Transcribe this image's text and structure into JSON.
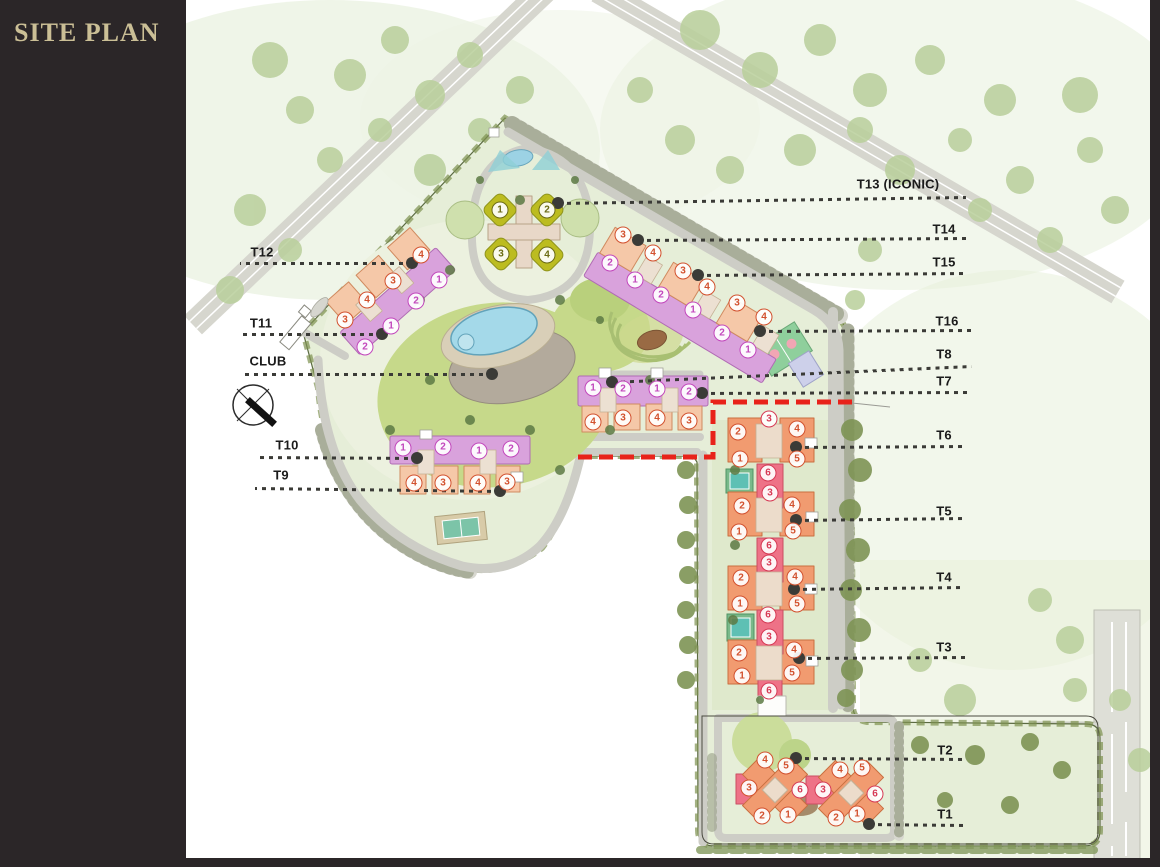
{
  "title": "SITE PLAN",
  "colors": {
    "sidebar_bg": "#2B2628",
    "title_gold": "#CBBF96",
    "label_ink": "#1B1B1B",
    "leader": "#3B3B37",
    "red_boundary": "#E8221A",
    "purple_building": "#D9A2DC",
    "salmon_building": "#F5C8A8",
    "olive_building": "#BCBC20",
    "orange_building": "#F19B70",
    "pink_building": "#EE7287",
    "marker_m": "#C247BC",
    "marker_o": "#D2512E",
    "marker_r": "#D63A55",
    "marker_y": "#6B6B14"
  },
  "callouts": [
    {
      "id": "T13",
      "label": "T13 (ICONIC)",
      "lx": 898,
      "ly": 184,
      "x1": 558,
      "y1": 203,
      "x2": 966,
      "y2": 197
    },
    {
      "id": "T14",
      "label": "T14",
      "lx": 944,
      "ly": 229,
      "x1": 638,
      "y1": 240,
      "x2": 966,
      "y2": 238
    },
    {
      "id": "T15",
      "label": "T15",
      "lx": 944,
      "ly": 262,
      "x1": 698,
      "y1": 275,
      "x2": 966,
      "y2": 273
    },
    {
      "id": "T16",
      "label": "T16",
      "lx": 947,
      "ly": 321,
      "x1": 760,
      "y1": 331,
      "x2": 972,
      "y2": 330
    },
    {
      "id": "T8",
      "label": "T8",
      "lx": 944,
      "ly": 354,
      "x1": 612,
      "y1": 382,
      "x2": 972,
      "y2": 366
    },
    {
      "id": "T7",
      "label": "T7",
      "lx": 944,
      "ly": 381,
      "x1": 702,
      "y1": 393,
      "x2": 972,
      "y2": 392
    },
    {
      "id": "T6",
      "label": "T6",
      "lx": 944,
      "ly": 435,
      "x1": 796,
      "y1": 447,
      "x2": 965,
      "y2": 446
    },
    {
      "id": "T5",
      "label": "T5",
      "lx": 944,
      "ly": 511,
      "x1": 796,
      "y1": 520,
      "x2": 965,
      "y2": 518
    },
    {
      "id": "T4",
      "label": "T4",
      "lx": 944,
      "ly": 577,
      "x1": 794,
      "y1": 589,
      "x2": 965,
      "y2": 587
    },
    {
      "id": "T3",
      "label": "T3",
      "lx": 944,
      "ly": 647,
      "x1": 799,
      "y1": 658,
      "x2": 965,
      "y2": 657
    },
    {
      "id": "T2",
      "label": "T2",
      "lx": 945,
      "ly": 750,
      "x1": 796,
      "y1": 758,
      "x2": 965,
      "y2": 759
    },
    {
      "id": "T1",
      "label": "T1",
      "lx": 945,
      "ly": 814,
      "x1": 869,
      "y1": 824,
      "x2": 965,
      "y2": 825
    },
    {
      "id": "T12",
      "label": "T12",
      "lx": 262,
      "ly": 252,
      "x1": 412,
      "y1": 263,
      "x2": 240,
      "y2": 263
    },
    {
      "id": "T11",
      "label": "T11",
      "lx": 261,
      "ly": 323,
      "x1": 382,
      "y1": 334,
      "x2": 240,
      "y2": 334
    },
    {
      "id": "CLUB",
      "label": "CLUB",
      "lx": 268,
      "ly": 361,
      "x1": 492,
      "y1": 374,
      "x2": 240,
      "y2": 374
    },
    {
      "id": "T10",
      "label": "T10",
      "lx": 287,
      "ly": 445,
      "x1": 417,
      "y1": 458,
      "x2": 255,
      "y2": 457
    },
    {
      "id": "T9",
      "label": "T9",
      "lx": 281,
      "ly": 475,
      "x1": 500,
      "y1": 491,
      "x2": 255,
      "y2": 488
    }
  ],
  "unit_markers": {
    "note": "circled apartment-unit numbers printed on building wings",
    "items": [
      [
        1,
        500,
        210,
        "y"
      ],
      [
        2,
        547,
        210,
        "y"
      ],
      [
        3,
        501,
        254,
        "y"
      ],
      [
        4,
        547,
        255,
        "y"
      ],
      [
        4,
        421,
        255,
        "o"
      ],
      [
        3,
        393,
        281,
        "o"
      ],
      [
        4,
        367,
        300,
        "o"
      ],
      [
        3,
        345,
        320,
        "o"
      ],
      [
        1,
        439,
        280,
        "m"
      ],
      [
        2,
        416,
        301,
        "m"
      ],
      [
        1,
        391,
        326,
        "m"
      ],
      [
        2,
        365,
        347,
        "m"
      ],
      [
        3,
        623,
        235,
        "o"
      ],
      [
        4,
        653,
        253,
        "o"
      ],
      [
        3,
        683,
        271,
        "o"
      ],
      [
        4,
        707,
        287,
        "o"
      ],
      [
        3,
        737,
        303,
        "o"
      ],
      [
        4,
        764,
        317,
        "o"
      ],
      [
        2,
        610,
        263,
        "m"
      ],
      [
        1,
        635,
        280,
        "m"
      ],
      [
        2,
        661,
        295,
        "m"
      ],
      [
        1,
        693,
        310,
        "m"
      ],
      [
        2,
        722,
        333,
        "m"
      ],
      [
        1,
        748,
        350,
        "m"
      ],
      [
        1,
        593,
        388,
        "m"
      ],
      [
        2,
        623,
        389,
        "m"
      ],
      [
        1,
        657,
        389,
        "m"
      ],
      [
        2,
        689,
        392,
        "m"
      ],
      [
        4,
        593,
        422,
        "o"
      ],
      [
        3,
        623,
        418,
        "o"
      ],
      [
        4,
        657,
        418,
        "o"
      ],
      [
        3,
        689,
        421,
        "o"
      ],
      [
        1,
        403,
        448,
        "m"
      ],
      [
        2,
        443,
        447,
        "m"
      ],
      [
        1,
        479,
        451,
        "m"
      ],
      [
        2,
        511,
        449,
        "m"
      ],
      [
        4,
        414,
        483,
        "o"
      ],
      [
        3,
        443,
        483,
        "o"
      ],
      [
        4,
        478,
        483,
        "o"
      ],
      [
        3,
        507,
        482,
        "o"
      ],
      [
        2,
        738,
        432,
        "o"
      ],
      [
        3,
        769,
        419,
        "r"
      ],
      [
        4,
        797,
        429,
        "o"
      ],
      [
        1,
        740,
        459,
        "o"
      ],
      [
        5,
        797,
        459,
        "o"
      ],
      [
        6,
        768,
        473,
        "r"
      ],
      [
        3,
        770,
        493,
        "r"
      ],
      [
        2,
        742,
        506,
        "o"
      ],
      [
        4,
        792,
        505,
        "o"
      ],
      [
        1,
        739,
        532,
        "o"
      ],
      [
        5,
        793,
        531,
        "o"
      ],
      [
        6,
        769,
        546,
        "r"
      ],
      [
        3,
        769,
        563,
        "r"
      ],
      [
        2,
        741,
        578,
        "o"
      ],
      [
        4,
        795,
        577,
        "o"
      ],
      [
        1,
        740,
        604,
        "o"
      ],
      [
        5,
        797,
        604,
        "o"
      ],
      [
        6,
        768,
        615,
        "r"
      ],
      [
        3,
        769,
        637,
        "r"
      ],
      [
        2,
        739,
        653,
        "o"
      ],
      [
        4,
        794,
        650,
        "o"
      ],
      [
        1,
        742,
        676,
        "o"
      ],
      [
        5,
        792,
        673,
        "o"
      ],
      [
        6,
        769,
        691,
        "r"
      ],
      [
        4,
        765,
        760,
        "o"
      ],
      [
        5,
        786,
        766,
        "o"
      ],
      [
        3,
        749,
        788,
        "o"
      ],
      [
        6,
        800,
        790,
        "r"
      ],
      [
        2,
        762,
        816,
        "o"
      ],
      [
        1,
        788,
        815,
        "o"
      ],
      [
        3,
        823,
        790,
        "r"
      ],
      [
        4,
        840,
        770,
        "o"
      ],
      [
        5,
        862,
        768,
        "o"
      ],
      [
        6,
        875,
        794,
        "r"
      ],
      [
        2,
        836,
        818,
        "o"
      ],
      [
        1,
        857,
        814,
        "o"
      ]
    ]
  },
  "map_features": [
    "north-arrow-compass",
    "swimming-pool",
    "club-deck",
    "amphitheatre",
    "basketball-court",
    "tennis-court",
    "entrance-gate",
    "red-phase-boundary",
    "perimeter-road",
    "parking-bays"
  ]
}
